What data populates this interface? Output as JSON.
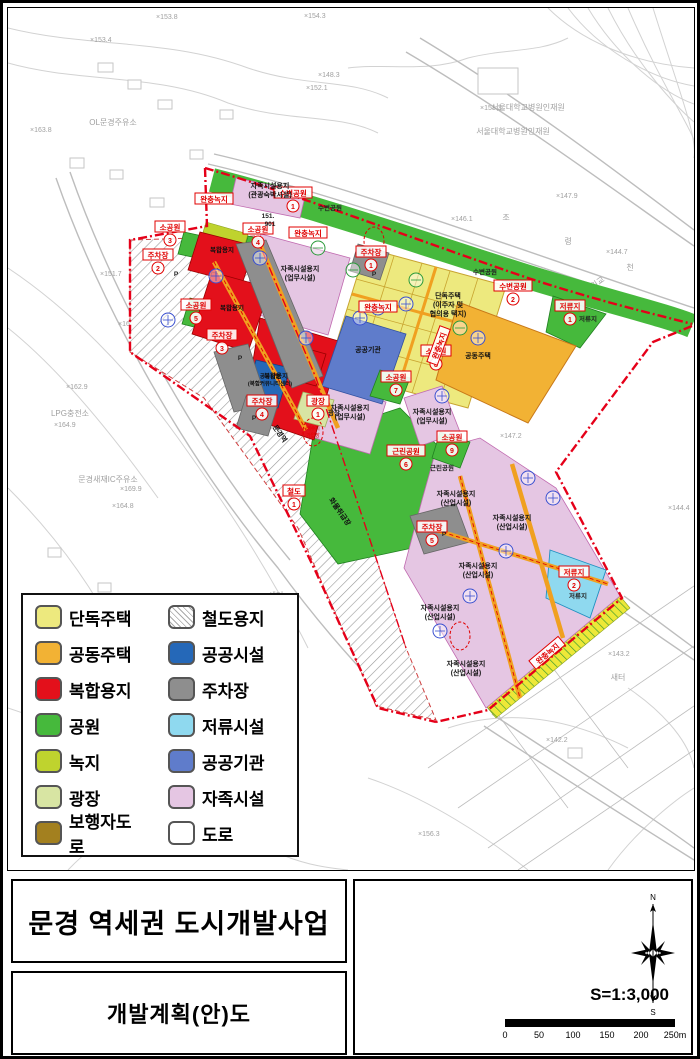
{
  "palette": {
    "boundary": "#e50019",
    "single_house": "#EDE97E",
    "apartment": "#F2B234",
    "mixed_use": "#E3101B",
    "park": "#46B93C",
    "greenbelt": "#BFD32E",
    "plaza": "#D8E5A3",
    "pedestrian": "#A3801F",
    "public_facility": "#2568B8",
    "parking": "#8E8E8E",
    "detention": "#8FD9EF",
    "public_agency": "#5F7CCB",
    "self_sufficiency": "#E5C6E3",
    "road": "#FFFFFF"
  },
  "legend": {
    "left": [
      {
        "label": "단독주택",
        "color": "#EDE97E"
      },
      {
        "label": "공동주택",
        "color": "#F2B234"
      },
      {
        "label": "복합용지",
        "color": "#E3101B"
      },
      {
        "label": "공원",
        "color": "#46B93C"
      },
      {
        "label": "녹지",
        "color": "#BFD32E"
      },
      {
        "label": "광장",
        "color": "#D8E5A3"
      },
      {
        "label": "보행자도로",
        "color": "#A3801F"
      }
    ],
    "right": [
      {
        "label": "철도용지",
        "color": "hatch"
      },
      {
        "label": "공공시설",
        "color": "#2568B8"
      },
      {
        "label": "주차장",
        "color": "#8E8E8E"
      },
      {
        "label": "저류시설",
        "color": "#8FD9EF"
      },
      {
        "label": "공공기관",
        "color": "#5F7CCB"
      },
      {
        "label": "자족시설",
        "color": "#E5C6E3"
      },
      {
        "label": "도로",
        "color": "#FFFFFF"
      }
    ]
  },
  "titles": {
    "project": "문경 역세권 도시개발사업",
    "sheet": "개발계획(안)도"
  },
  "scalebox": {
    "scale_text": "S=1:3,000",
    "ticks": [
      "0",
      "50",
      "100",
      "150",
      "200",
      "250m"
    ],
    "north": "N",
    "south": "S"
  },
  "map": {
    "zone_labels": [
      {
        "t": "수변공원",
        "x": 285,
        "y": 186,
        "n": "1"
      },
      {
        "t": "수변공원",
        "x": 505,
        "y": 279,
        "n": "2"
      },
      {
        "t": "저류지",
        "x": 562,
        "y": 299,
        "n": "1"
      },
      {
        "t": "저류지",
        "x": 566,
        "y": 565,
        "n": "2"
      },
      {
        "t": "소공원",
        "x": 162,
        "y": 220,
        "n": "3"
      },
      {
        "t": "소공원",
        "x": 250,
        "y": 222,
        "n": "4"
      },
      {
        "t": "소공원",
        "x": 188,
        "y": 298,
        "n": "5"
      },
      {
        "t": "근린공원",
        "x": 398,
        "y": 444,
        "n": "6"
      },
      {
        "t": "소공원",
        "x": 388,
        "y": 370,
        "n": "7"
      },
      {
        "t": "소공원",
        "x": 428,
        "y": 344,
        "n": "8"
      },
      {
        "t": "소공원",
        "x": 444,
        "y": 430,
        "n": "9"
      },
      {
        "t": "주차장",
        "x": 363,
        "y": 245,
        "n": "1"
      },
      {
        "t": "주차장",
        "x": 150,
        "y": 248,
        "n": "2"
      },
      {
        "t": "주차장",
        "x": 214,
        "y": 328,
        "n": "3"
      },
      {
        "t": "주차장",
        "x": 254,
        "y": 394,
        "n": "4"
      },
      {
        "t": "주차장",
        "x": 424,
        "y": 520,
        "n": "5"
      },
      {
        "t": "철도",
        "x": 286,
        "y": 484,
        "n": "1"
      },
      {
        "t": "광장",
        "x": 310,
        "y": 394,
        "n": "1"
      },
      {
        "t": "완충녹지",
        "x": 206,
        "y": 192
      },
      {
        "t": "완충녹지",
        "x": 300,
        "y": 226
      },
      {
        "t": "완충녹지",
        "x": 370,
        "y": 300
      },
      {
        "t": "완충녹지",
        "x": 432,
        "y": 338,
        "rot": -70
      },
      {
        "t": "완충녹지",
        "x": 540,
        "y": 646,
        "rot": -40
      }
    ],
    "area_texts": [
      {
        "lines": [
          "자족시설용지",
          "(관광숙박시설)"
        ],
        "x": 262,
        "y": 180
      },
      {
        "lines": [
          "자족시설용지",
          "(업무시설)"
        ],
        "x": 292,
        "y": 263
      },
      {
        "lines": [
          "자족시설용지",
          "(업무시설)"
        ],
        "x": 342,
        "y": 402
      },
      {
        "lines": [
          "자족시설용지",
          "(업무시설)"
        ],
        "x": 424,
        "y": 406
      },
      {
        "lines": [
          "단독주택",
          "(이주자 및",
          "협의용 택지)"
        ],
        "x": 440,
        "y": 290
      },
      {
        "lines": [
          "공동주택"
        ],
        "x": 470,
        "y": 350
      },
      {
        "lines": [
          "공공기관"
        ],
        "x": 360,
        "y": 344
      },
      {
        "lines": [
          "공공시설",
          "(복합커뮤니티센터)"
        ],
        "x": 262,
        "y": 370,
        "size": 5.5
      },
      {
        "lines": [
          "자족시설용지",
          "(산업시설)"
        ],
        "x": 448,
        "y": 488
      },
      {
        "lines": [
          "자족시설용지",
          "(산업시설)"
        ],
        "x": 504,
        "y": 512
      },
      {
        "lines": [
          "자족시설용지",
          "(산업시설)"
        ],
        "x": 470,
        "y": 560
      },
      {
        "lines": [
          "자족시설용지",
          "(산업시설)"
        ],
        "x": 432,
        "y": 602
      },
      {
        "lines": [
          "자족시설용지",
          "(산업시설)"
        ],
        "x": 458,
        "y": 658
      },
      {
        "lines": [
          "복합용지"
        ],
        "x": 214,
        "y": 244,
        "size": 6.5
      },
      {
        "lines": [
          "복합용지"
        ],
        "x": 224,
        "y": 302,
        "size": 6.5
      },
      {
        "lines": [
          "복합용지"
        ],
        "x": 268,
        "y": 370,
        "size": 6.5
      },
      {
        "lines": [
          "화물취급장"
        ],
        "x": 330,
        "y": 505,
        "rot": 55
      },
      {
        "lines": [
          "문경역"
        ],
        "x": 270,
        "y": 427,
        "rot": 55
      }
    ],
    "small_texts": [
      {
        "t": "수변공원",
        "x": 322,
        "y": 202
      },
      {
        "t": "수변공원",
        "x": 477,
        "y": 266
      },
      {
        "t": "저류지",
        "x": 580,
        "y": 313
      },
      {
        "t": "저류지",
        "x": 570,
        "y": 590
      },
      {
        "t": "근린공원",
        "x": 434,
        "y": 462
      },
      {
        "t": "광장",
        "x": 326,
        "y": 407
      },
      {
        "t": "P",
        "x": 366,
        "y": 268
      },
      {
        "t": "P",
        "x": 168,
        "y": 268
      },
      {
        "t": "P",
        "x": 232,
        "y": 352
      },
      {
        "t": "P",
        "x": 246,
        "y": 412
      },
      {
        "t": "P",
        "x": 436,
        "y": 528
      },
      {
        "t": "151.",
        "x": 260,
        "y": 210
      },
      {
        "t": "901",
        "x": 262,
        "y": 218
      }
    ],
    "bg_texts": [
      {
        "t": "서울대학교병원인재원",
        "x": 520,
        "y": 102
      },
      {
        "t": "서울대학교병원인재원",
        "x": 505,
        "y": 126
      },
      {
        "t": "OL문경주유소",
        "x": 105,
        "y": 117
      },
      {
        "t": "LPG충전소",
        "x": 62,
        "y": 408
      },
      {
        "t": "문경새재IC주유소",
        "x": 100,
        "y": 474
      },
      {
        "t": "마원교",
        "x": 588,
        "y": 279,
        "rot": -35
      },
      {
        "t": "새터",
        "x": 268,
        "y": 590
      },
      {
        "t": "새터",
        "x": 610,
        "y": 672
      },
      {
        "t": "조",
        "x": 498,
        "y": 212
      },
      {
        "t": "령",
        "x": 560,
        "y": 236
      },
      {
        "t": "천",
        "x": 622,
        "y": 262
      }
    ],
    "elevations": [
      {
        "t": "×153.4",
        "x": 82,
        "y": 34
      },
      {
        "t": "×153.8",
        "x": 148,
        "y": 11
      },
      {
        "t": "×154.3",
        "x": 296,
        "y": 10
      },
      {
        "t": "×148.3",
        "x": 310,
        "y": 69
      },
      {
        "t": "×152.1",
        "x": 298,
        "y": 82
      },
      {
        "t": "×151.3",
        "x": 472,
        "y": 102
      },
      {
        "t": "×147.9",
        "x": 548,
        "y": 190
      },
      {
        "t": "×146.1",
        "x": 443,
        "y": 213
      },
      {
        "t": "×144.7",
        "x": 598,
        "y": 246
      },
      {
        "t": "×147.2",
        "x": 492,
        "y": 430
      },
      {
        "t": "×144.4",
        "x": 660,
        "y": 502
      },
      {
        "t": "×143.2",
        "x": 600,
        "y": 648
      },
      {
        "t": "×142.2",
        "x": 538,
        "y": 734
      },
      {
        "t": "×156.3",
        "x": 410,
        "y": 828
      },
      {
        "t": "×162.9",
        "x": 58,
        "y": 381
      },
      {
        "t": "×164.9",
        "x": 46,
        "y": 419
      },
      {
        "t": "×169.9",
        "x": 112,
        "y": 483
      },
      {
        "t": "×164.8",
        "x": 104,
        "y": 500
      },
      {
        "t": "×163.8",
        "x": 22,
        "y": 124
      },
      {
        "t": "×151.7",
        "x": 92,
        "y": 268
      },
      {
        "t": "×164.1",
        "x": 110,
        "y": 318
      }
    ],
    "blue_stamps": [
      [
        252,
        250
      ],
      [
        208,
        268
      ],
      [
        160,
        312
      ],
      [
        298,
        330
      ],
      [
        352,
        310
      ],
      [
        398,
        296
      ],
      [
        434,
        388
      ],
      [
        470,
        330
      ],
      [
        545,
        490
      ],
      [
        498,
        543
      ],
      [
        462,
        588
      ],
      [
        432,
        623
      ],
      [
        520,
        470
      ],
      [
        370,
        300
      ]
    ],
    "green_stamps": [
      [
        345,
        262
      ],
      [
        408,
        272
      ],
      [
        452,
        320
      ],
      [
        310,
        240
      ]
    ],
    "red_stamps": [
      {
        "x": 305,
        "y": 424,
        "l1": "배수지",
        "l2": "가압장"
      },
      {
        "x": 452,
        "y": 628
      },
      {
        "x": 366,
        "y": 233
      }
    ]
  }
}
